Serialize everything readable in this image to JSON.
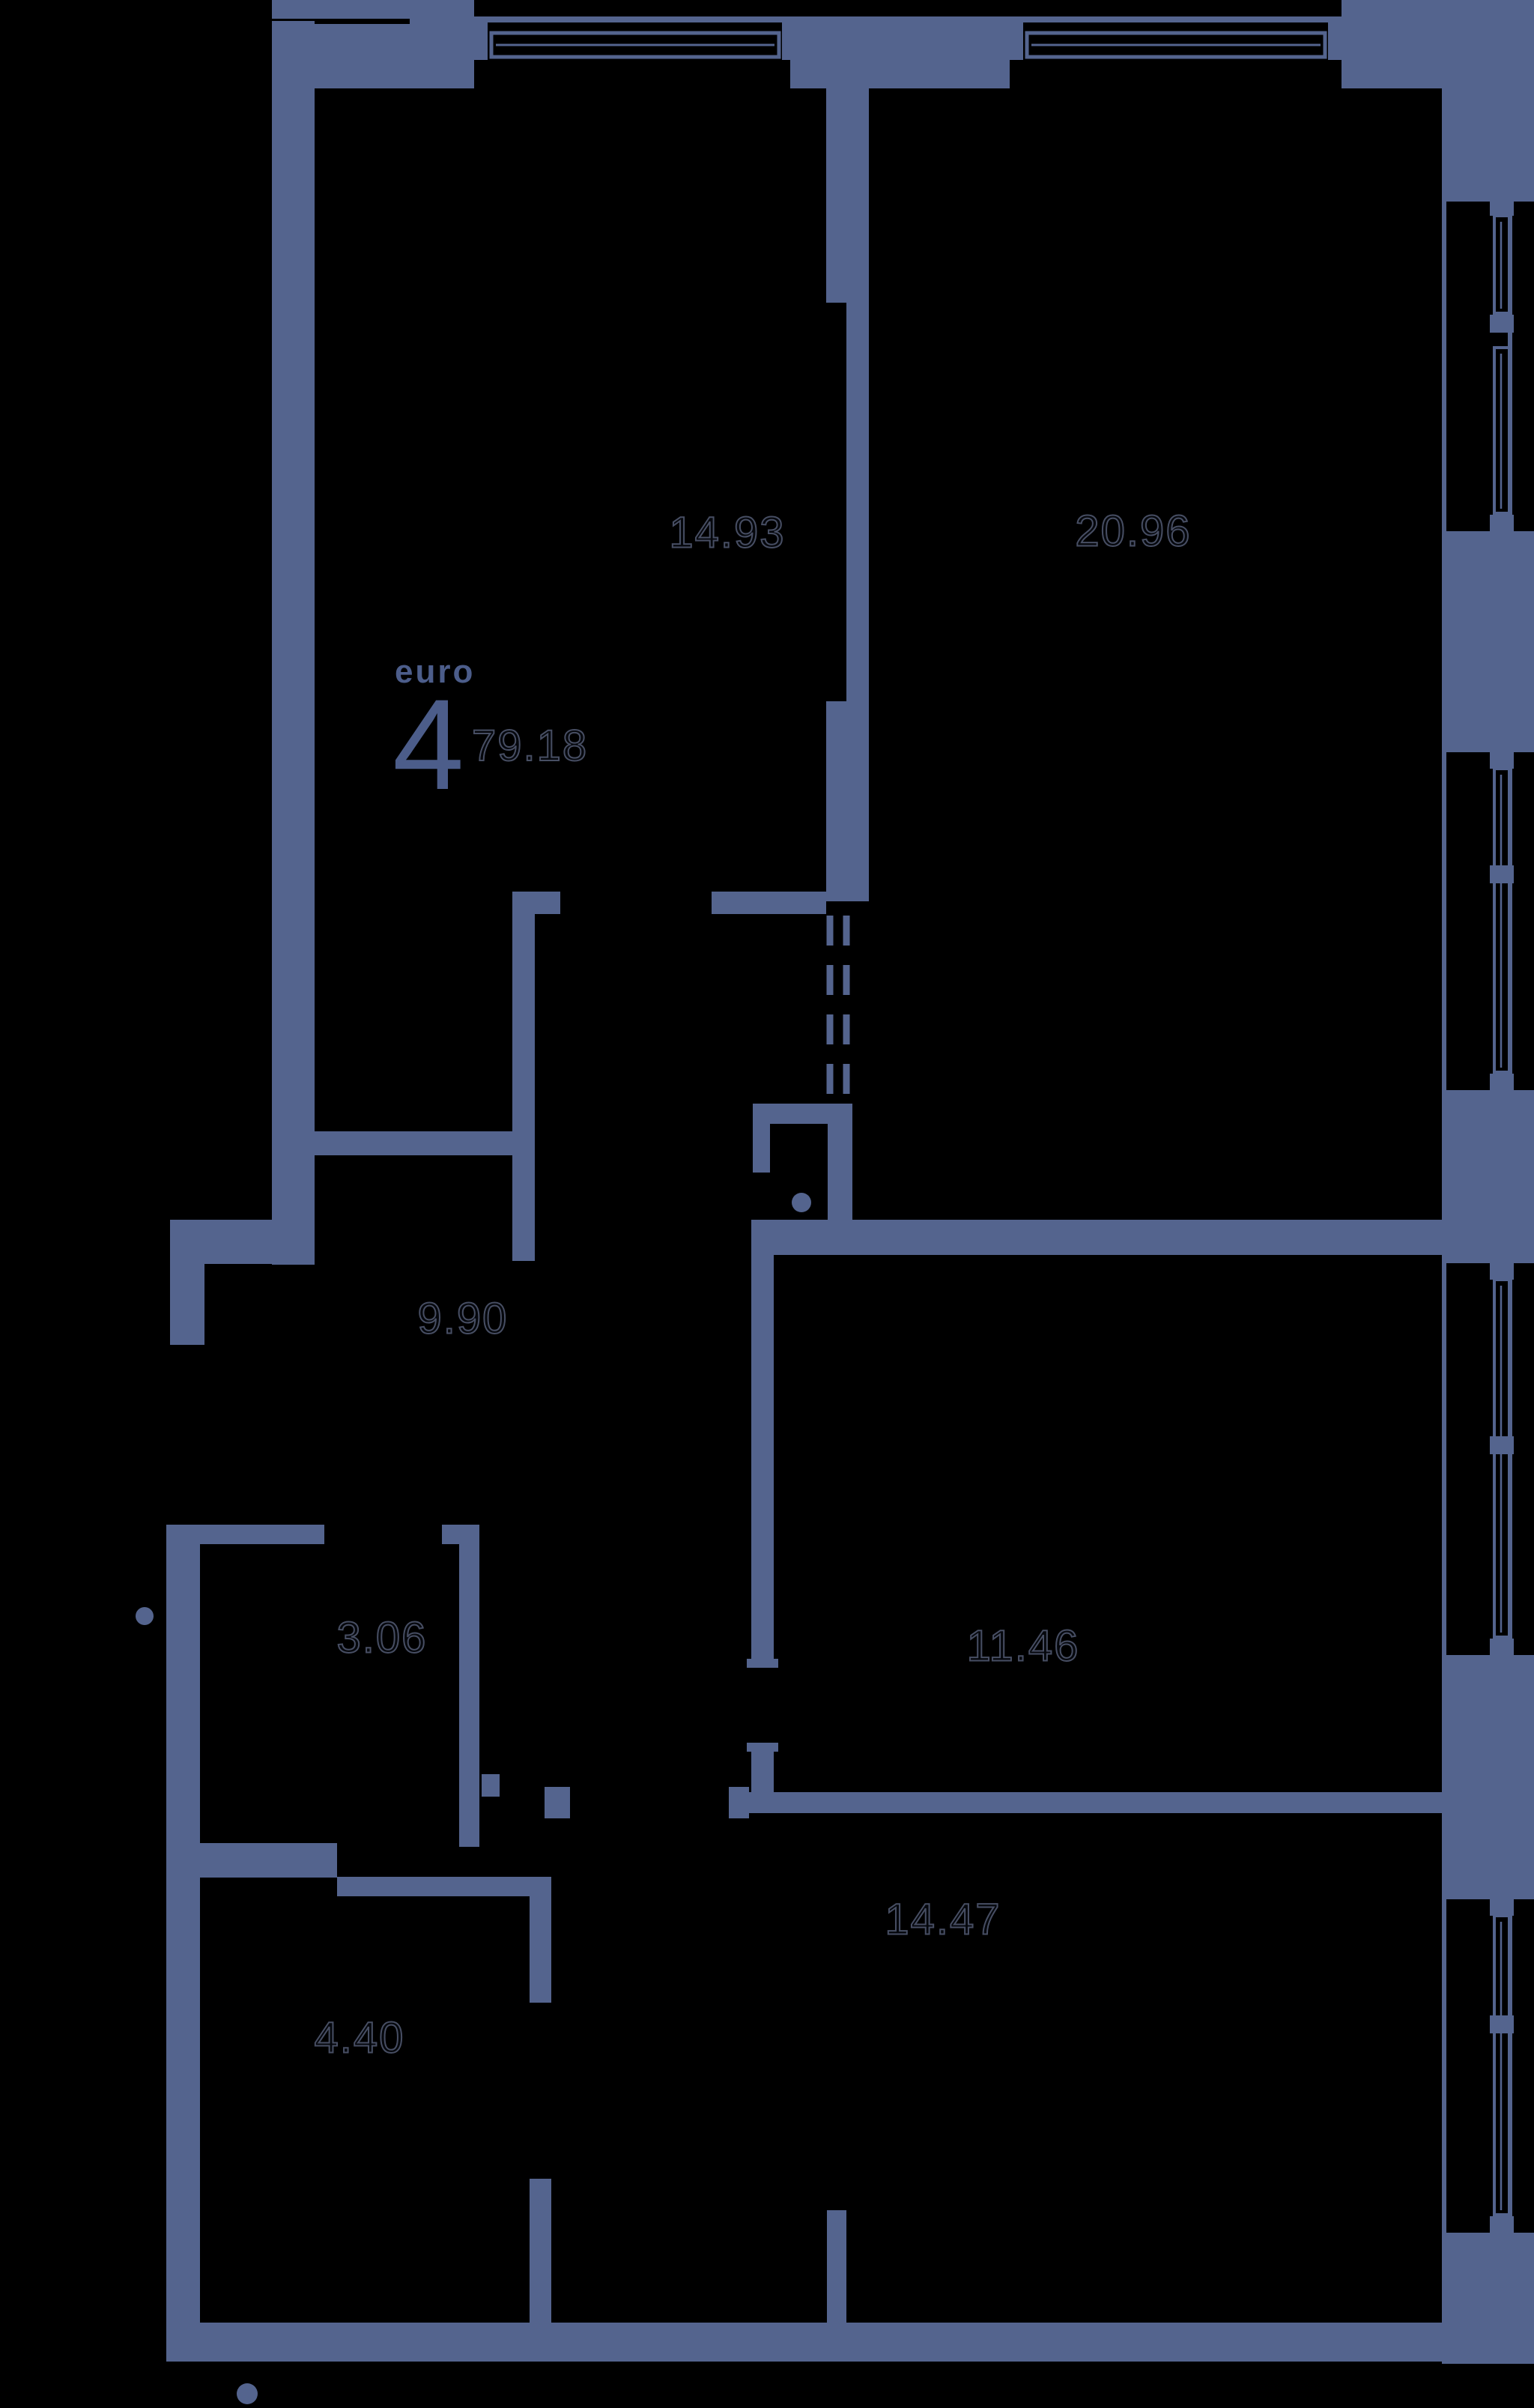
{
  "plan": {
    "unit_type_label": "euro",
    "unit_rooms_count": "4",
    "total_area": "79.18",
    "rooms": [
      {
        "id": "kitchen-living",
        "area": "14.93"
      },
      {
        "id": "living-room",
        "area": "20.96"
      },
      {
        "id": "corridor",
        "area": "9.90"
      },
      {
        "id": "bathroom",
        "area": "3.06"
      },
      {
        "id": "bedroom-1",
        "area": "11.46"
      },
      {
        "id": "bedroom-2",
        "area": "14.47"
      },
      {
        "id": "bathroom-2",
        "area": "4.40"
      }
    ],
    "colors": {
      "background": "#000000",
      "wall": "#54648e",
      "accent_text": "#4c5d8a",
      "room_label_outline": "#474e63"
    }
  }
}
